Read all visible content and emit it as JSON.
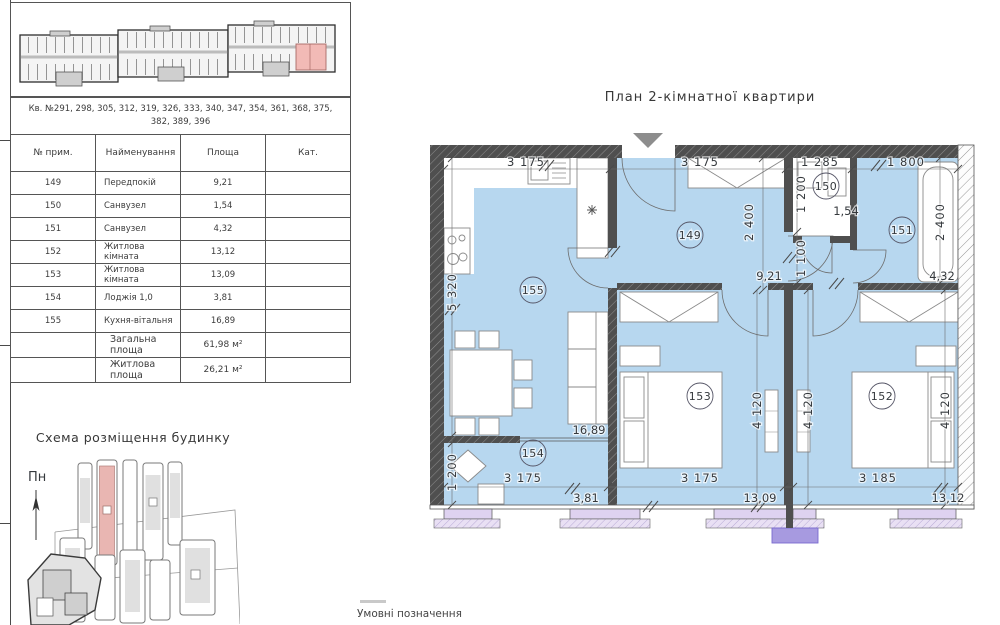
{
  "plan": {
    "title": "План 2-кімнатної квартири",
    "legend": "Умовні позначення",
    "rooms": {
      "hall": "149",
      "wc": "150",
      "bath": "151",
      "bed2": "152",
      "bed1": "153",
      "loggia": "154",
      "kitchen": "155"
    },
    "areas": {
      "hall": "9,21",
      "wc": "1,54",
      "bath": "4,32",
      "bed2": "13,12",
      "bed1": "13,09",
      "loggia": "3,81",
      "kitchen": "16,89"
    },
    "dims": {
      "top_kitchen": "3 175",
      "top_hall": "3 175",
      "top_wc": "1 285",
      "top_bath": "1 800",
      "left_kitchen": "5 320",
      "hall_depth": "2 400",
      "wc_depth": "1 200",
      "pass_depth": "1 100",
      "bath_depth": "2 400",
      "loggia_left": "1 200",
      "bed_depth": "4 120",
      "bottom_loggia": "3 175",
      "bottom_bed1": "3 175",
      "bottom_bed2": "3 185"
    }
  },
  "table": {
    "apartments_header": "Кв. №291, 298, 305, 312, 319, 326, 333, 340, 347, 354, 361, 368, 375, 382, 389, 396",
    "columns": [
      "№ прим.",
      "Найменування",
      "Площа",
      "Кат."
    ],
    "rows": [
      {
        "num": "149",
        "name": "Передпокій",
        "area": "9,21",
        "cat": ""
      },
      {
        "num": "150",
        "name": "Санвузел",
        "area": "1,54",
        "cat": ""
      },
      {
        "num": "151",
        "name": "Санвузел",
        "area": "4,32",
        "cat": ""
      },
      {
        "num": "152",
        "name": "Житлова кімната",
        "area": "13,12",
        "cat": ""
      },
      {
        "num": "153",
        "name": "Житлова кімната",
        "area": "13,09",
        "cat": ""
      },
      {
        "num": "154",
        "name": "Лоджія 1,0",
        "area": "3,81",
        "cat": ""
      },
      {
        "num": "155",
        "name": "Кухня-вітальня",
        "area": "16,89",
        "cat": ""
      }
    ],
    "totals": [
      {
        "label": "Загальна площа",
        "value": "61,98 м²"
      },
      {
        "label": "Житлова площа",
        "value": "26,21 м²"
      }
    ]
  },
  "scheme": {
    "title": "Схема розміщення будинку",
    "north": "Пн"
  },
  "colors": {
    "room_fill": "#b7d7ef",
    "wall": "#4f4f4f",
    "window_sill": "#ded2f0",
    "balcony_marker": "#a79ae0",
    "highlight_apartment": "#f2bab6"
  }
}
